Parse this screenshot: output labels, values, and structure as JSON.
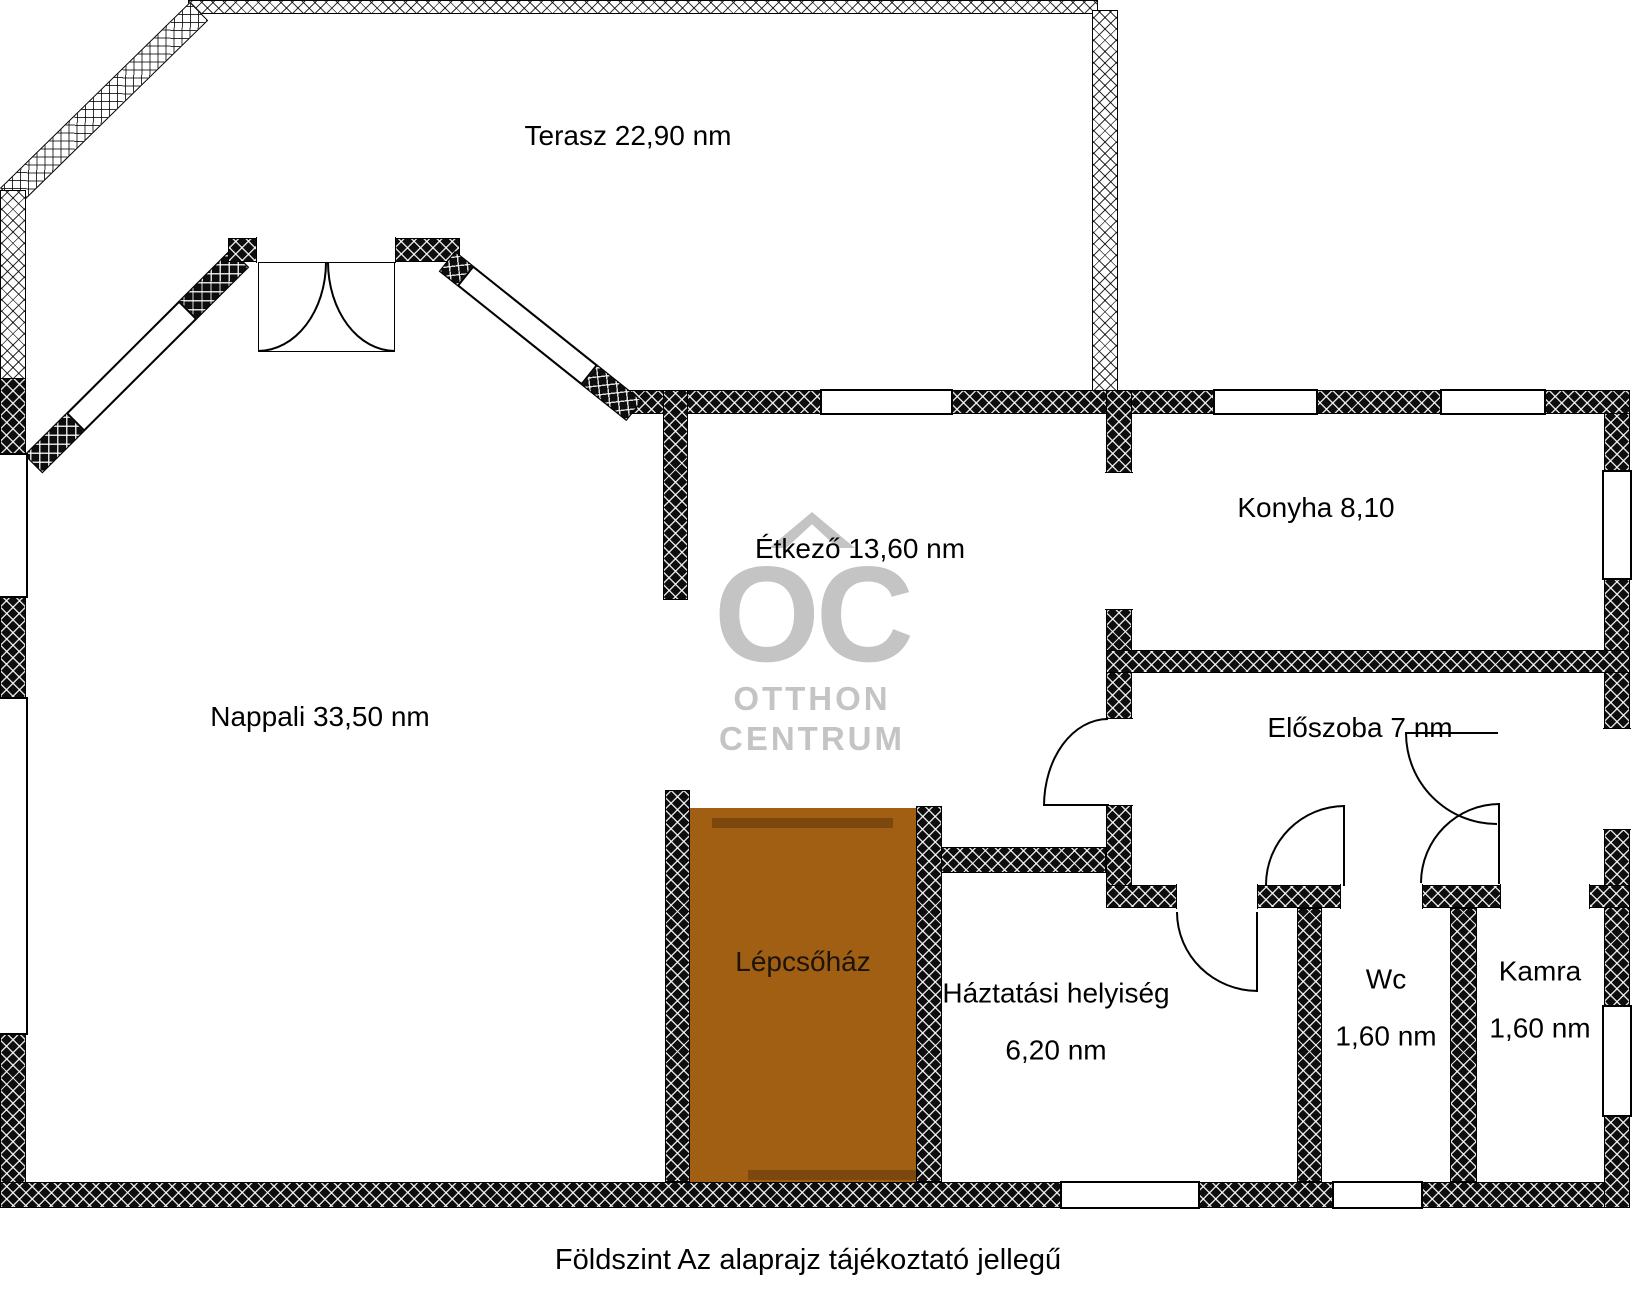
{
  "plan": {
    "caption": "Földszint Az alaprajz tájékoztató jellegű",
    "rooms": [
      {
        "id": "terasz",
        "label": "Terasz 22,90 nm"
      },
      {
        "id": "nappali",
        "label": "Nappali 33,50 nm"
      },
      {
        "id": "etkezo",
        "label": "Étkező 13,60 nm"
      },
      {
        "id": "konyha",
        "label": "Konyha 8,10"
      },
      {
        "id": "eloszoba",
        "label": "Előszoba 7 nm"
      },
      {
        "id": "lepcsohaz",
        "label": "Lépcsőház"
      },
      {
        "id": "haztartasi",
        "label": "Háztatási helyiség",
        "area": "6,20 nm"
      },
      {
        "id": "wc",
        "label": "Wc",
        "area": "1,60 nm"
      },
      {
        "id": "kamra",
        "label": "Kamra",
        "area": "1,60 nm"
      }
    ],
    "watermark": {
      "line1": "OC",
      "line2": "OTTHON",
      "line3": "CENTRUM"
    },
    "colors": {
      "wall_black": "#0d0d0d",
      "stair_fill": "#a05f12",
      "stair_trim": "#7d480e",
      "watermark_gray": "#c4c4c4"
    }
  }
}
